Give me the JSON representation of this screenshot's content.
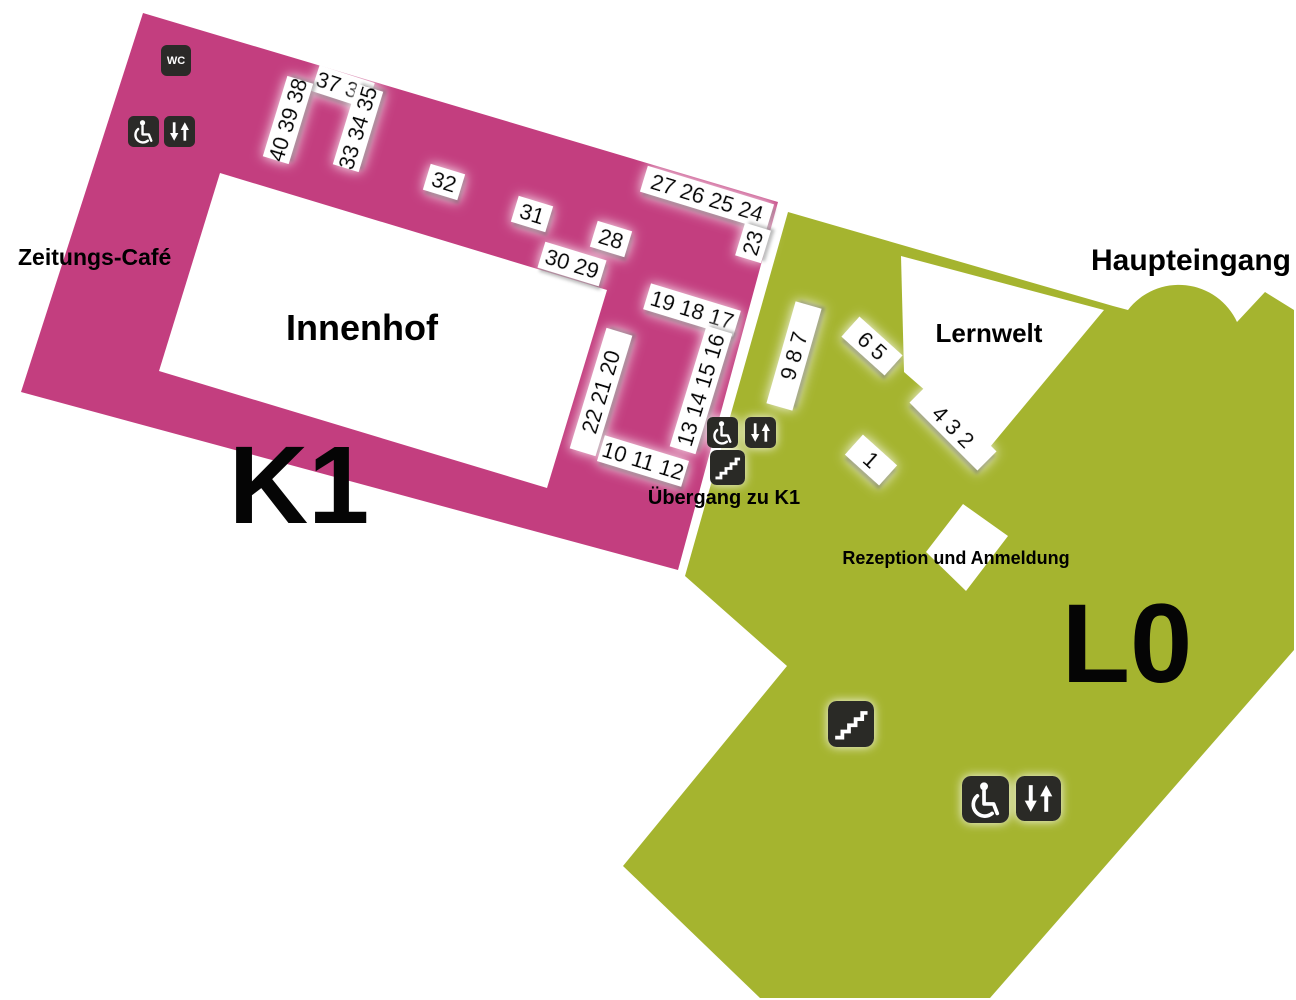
{
  "colors": {
    "k1_area": "#c33e7f",
    "l0_area": "#a5b42f",
    "icon_bg": "#2b2a28",
    "courtyard": "#ffffff"
  },
  "floors": {
    "k1": {
      "label": "K1"
    },
    "l0": {
      "label": "L0"
    }
  },
  "places": {
    "zeitungs_cafe": "Zeitungs-Café",
    "innenhof": "Innenhof",
    "lernwelt": "Lernwelt",
    "haupteingang": "Haupteingang",
    "uebergang_zu_k1": "Übergang zu K1",
    "rezeption": "Rezeption und Anmeldung"
  },
  "icons": {
    "wc_label": "WC",
    "wc": "wc-icon",
    "wheelchair": "wheelchair-icon",
    "elevator": "elevator-icon",
    "stairs": "stairs-icon"
  },
  "shelves": [
    {
      "label": "37 36"
    },
    {
      "label": "40 39 38"
    },
    {
      "label": "33 34 35"
    },
    {
      "label": "32"
    },
    {
      "label": "31"
    },
    {
      "label": "28"
    },
    {
      "label": "30 29"
    },
    {
      "label": "27 26 25 24"
    },
    {
      "label": "23"
    },
    {
      "label": "19 18 17"
    },
    {
      "label": "22 21 20"
    },
    {
      "label": "13 14 15 16"
    },
    {
      "label": "10 11 12"
    },
    {
      "label": "9 8 7"
    },
    {
      "label": "6 5"
    },
    {
      "label": "4 3 2"
    },
    {
      "label": "1"
    }
  ]
}
